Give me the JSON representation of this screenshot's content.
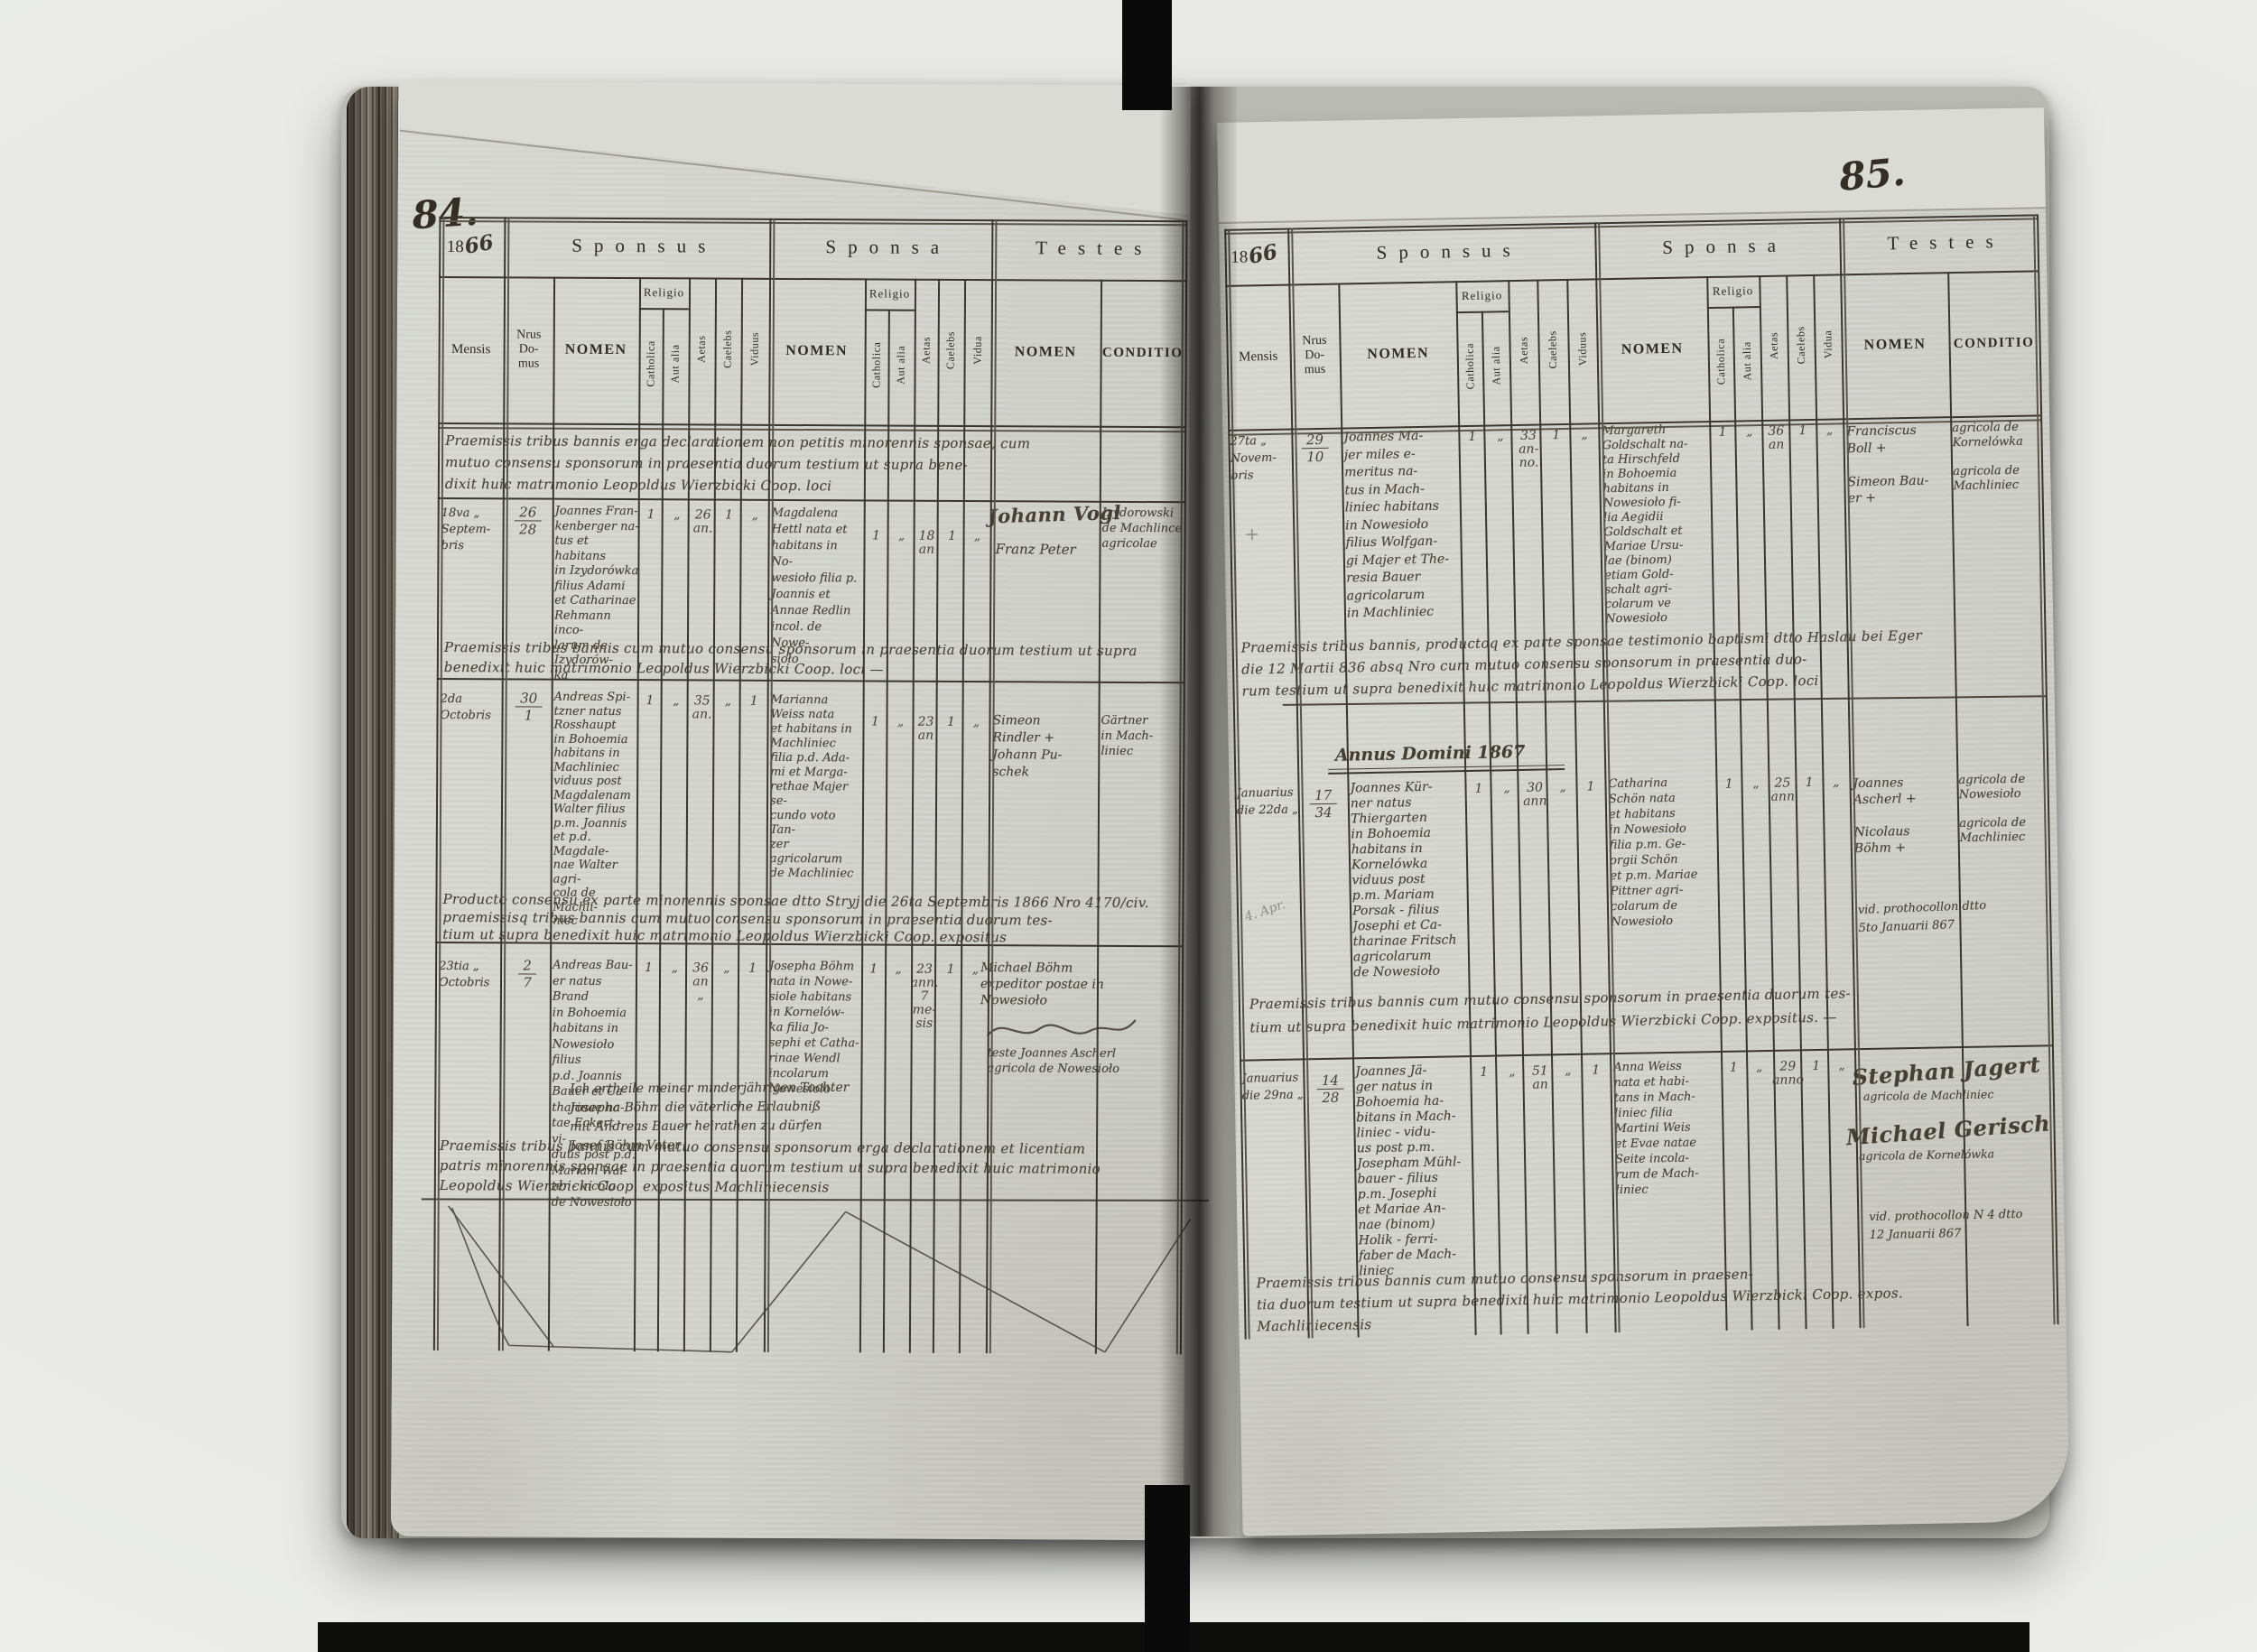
{
  "headers": {
    "year_printed": "18",
    "sponsus": "Sponsus",
    "sponsa": "Sponsa",
    "testes": "Testes",
    "mensis": "Mensis",
    "nrus_domus": "Nrus\nDo-\nmus",
    "nomen": "NOMEN",
    "religio": "Religio",
    "catholica": "Catholica",
    "aut_alia": "Aut alia",
    "aetas": "Aetas",
    "caelebs": "Caelebs",
    "viduus": "Viduus",
    "vidua": "Vidua",
    "conditio": "CONDITIO"
  },
  "left": {
    "page_number": "84.",
    "year_hand": "66",
    "note_top": "Praemissis tribus bannis erga declarationem non petitis minorennis sponsae, cum\nmutuo consensu sponsorum in praesentia duorum testium ut supra bene-\ndixit huic matrimonio Leopoldus Wierzbicki Coop. loci",
    "e1": {
      "mensis": "18va „\nSeptem-\nbris",
      "nrus_a": "26",
      "nrus_b": "28",
      "sponsus": "Joannes Fran-\nkenberger na-\ntus et habitans\nin Izydorówka\nfilius Adami\net Catharinae\nRehmann inco-\nlarum de Izydorów-\nka",
      "sm": [
        "1",
        "„",
        "26\nan.",
        "1",
        "„"
      ],
      "sponsa": "Magdalena\nHettl nata et\nhabitans in No-\nwesioło filia p.\nJoannis et\nAnnae Redlin\nincol. de Nowe-\nsioło",
      "pm": [
        "1",
        "„",
        "18\nan",
        "1",
        "„"
      ],
      "sig1": "Johann Vogl",
      "sig2": "Franz Peter",
      "conditio": "Izydorowski\nde Machlince\nagricolae"
    },
    "note_e1": "Praemissis tribus bannis cum mutuo consensu sponsorum in praesentia duorum testium ut supra\nbenedixit huic matrimonio Leopoldus Wierzbicki Coop. loci —",
    "e2": {
      "mensis": "2da\nOctobris",
      "nrus_a": "30",
      "nrus_b": "1",
      "sponsus": "Andreas Spi-\ntzner natus\nRosshaupt\nin Bohoemia\nhabitans in\nMachliniec\nviduus post\nMagdalenam\nWalter filius\np.m. Joannis\net p.d. Magdale-\nnae Walter agri-\ncola de Machli-\nniec",
      "sm": [
        "1",
        "„",
        "35\nan.",
        "„",
        "1"
      ],
      "sponsa": "Marianna\nWeiss nata\net habitans in\nMachliniec\nfilia p.d. Ada-\nmi et Marga-\nrethae Majer se-\ncundo voto Tan-\nzer agricolarum\nde Machliniec",
      "pm": [
        "1",
        "„",
        "23\nan",
        "1",
        "„"
      ],
      "testes": "Simeon\nRindler +\nJohann Pu-\nschek",
      "conditio": "Gärtner\nin Mach-\nliniec"
    },
    "note_e2": "Producto consensu ex parte minorennis sponsae dtto Stryj die 26ta Septembris 1866 Nro 4170/civ.\npraemissisq tribus bannis cum mutuo consensu sponsorum in praesentia duorum tes-\ntium ut supra benedixit huic matrimonio Leopoldus Wierzbicki Coop. expositus",
    "e3": {
      "mensis": "23tia „\nOctobris",
      "nrus_a": "2",
      "nrus_b": "7",
      "sponsus": "Andreas Bau-\ner natus Brand\nin Bohoemia\nhabitans in\nNowesioło filius\np.d. Joannis\nBauer et Ca-\ntharinae na-\ntae Eckert - vi-\nduus post p.d.\nMariam Wal-\nter - incola\nde Nowesioło",
      "sm": [
        "1",
        "„",
        "36\nan\n„",
        "„",
        "1"
      ],
      "sponsa": "Josepha Böhm\nnata in Nowe-\nsiole habitans\nin Kornelów-\nka filia Jo-\nsephi et Catha-\nrinae Wendl\nincolarum\nNowesioło",
      "pm": [
        "1",
        "„",
        "23\nann.\n7 me-\nsis",
        "1",
        "„"
      ],
      "testes": "Michael Böhm\nexpeditor postae in\nNowesioło",
      "testes_sub": "teste Joannes Ascherl\nagricola de Nowesioło",
      "german_note": "Ich ertheile meiner minderjährigen Tochter\nJosepha Böhm die väterliche Erlaubniß\nmit Andreas Bauer heirathen zu dürfen\nJosef Böhm  Vater"
    },
    "note_e3": "Praemissis tribus bannis cum mutuo consensu sponsorum erga declarationem et licentiam\npatris minorennis sponsae in praesentia duorum testium ut supra benedixit huic matrimonio\nLeopoldus Wierzbicki Coop. expositus Machliniecensis"
  },
  "right": {
    "page_number": "85.",
    "year_hand": "66",
    "pencil_plus": "+",
    "e1": {
      "mensis": "27ta „\nNovem-\nbris",
      "nrus_a": "29",
      "nrus_b": "10",
      "sponsus": "Joannes Ma-\njer miles e-\nmeritus na-\ntus in Mach-\nliniec habitans\nin Nowesioło\nfilius Wolfgan-\ngi Majer et The-\nresia Bauer\nagricolarum\nin Machliniec",
      "sm": [
        "1",
        "„",
        "33\nan-\nno.",
        "1",
        "„"
      ],
      "sponsa": "Margareth\nGoldschalt na-\nta Hirschfeld\nin Bohoemia\nhabitans in\nNowesioło fi-\nlia Aegidii\nGoldschalt et\nMariae Ursu-\nlae (binom)\netiam Gold-\nschalt agri-\ncolarum ve\nNowesioło",
      "pm": [
        "1",
        "„",
        "36\nan",
        "1",
        "„"
      ],
      "testes": "Franciscus\nBoll +\n\nSimeon Bau-\ner +",
      "conditio": "agricola de\nKornelówka\n\nagricola de\nMachliniec"
    },
    "note_e1": "Praemissis tribus bannis, productoq ex parte sponsae testimonio baptismi dtto Haslau bei Eger\ndie 12 Martii 836 absq Nro cum mutuo consensu sponsorum in praesentia duo-\nrum testium ut supra benedixit huic matrimonio Leopoldus Wierzbicki Coop. loci",
    "annus_heading": "Annus Domini 1867",
    "e2": {
      "mensis": "Januarius\ndie 22da „",
      "pencil_note": "4. Apr.",
      "nrus_a": "17",
      "nrus_b": "34",
      "sponsus": "Joannes Kür-\nner natus\nThiergarten\nin Bohoemia\nhabitans in\nKornelówka\nviduus post\np.m. Mariam\nPorsak - filius\nJosephi et Ca-\ntharinae Fritsch\nagricolarum\nde Nowesioło",
      "sm": [
        "1",
        "„",
        "30\nann",
        "„",
        "1"
      ],
      "sponsa": "Catharina\nSchön nata\net habitans\nin Nowesioło\nfilia p.m. Ge-\norgii Schön\net p.m. Mariae\nPittner agri-\ncolarum de\nNowesioło",
      "pm": [
        "1",
        "„",
        "25\nann",
        "1",
        "„"
      ],
      "testes": "Joannes\nAscherl +\n\nNicolaus\nBöhm +",
      "conditio": "agricola de\nNowesioło\n\nagricola de\nMachliniec",
      "vid_note": "vid. prothocollon dtto\n5to Januarii 867"
    },
    "note_e2": "Praemissis tribus bannis cum mutuo consensu sponsorum in praesentia duorum tes-\ntium ut supra benedixit huic matrimonio Leopoldus Wierzbicki Coop. expositus. —",
    "e3": {
      "mensis": "Januarius\ndie 29na „",
      "nrus_a": "14",
      "nrus_b": "28",
      "sponsus": "Joannes Jä-\nger natus in\nBohoemia ha-\nbitans in Mach-\nliniec - vidu-\nus post p.m.\nJosepham Mühl-\nbauer - filius\np.m. Josephi\net Mariae An-\nnae (binom)\nHolik - ferri-\nfaber de Mach-\nliniec",
      "sm": [
        "1",
        "„",
        "51\nan",
        "„",
        "1"
      ],
      "sponsa": "Anna Weiss\nnata et habi-\ntans in Mach-\nliniec filia\nMartini Weis\net Evae natae\nSeite incola-\nrum de Mach-\nliniec",
      "pm": [
        "1",
        "„",
        "29\nanno",
        "1",
        "„"
      ],
      "sig1": "Stephan Jagert",
      "sig1_sub": "agricola de Machliniec",
      "sig2": "Michael Gerisch",
      "sig2_sub": "agricola de Kornelówka",
      "vid_note": "vid. prothocollon N 4 dtto\n12 Januarii 867"
    },
    "note_e3": "Praemissis tribus bannis cum mutuo consensu sponsorum in praesen-\ntia duorum testium ut supra benedixit huic matrimonio Leopoldus Wierzbicki Coop. expos.\nMachliniecensis"
  }
}
